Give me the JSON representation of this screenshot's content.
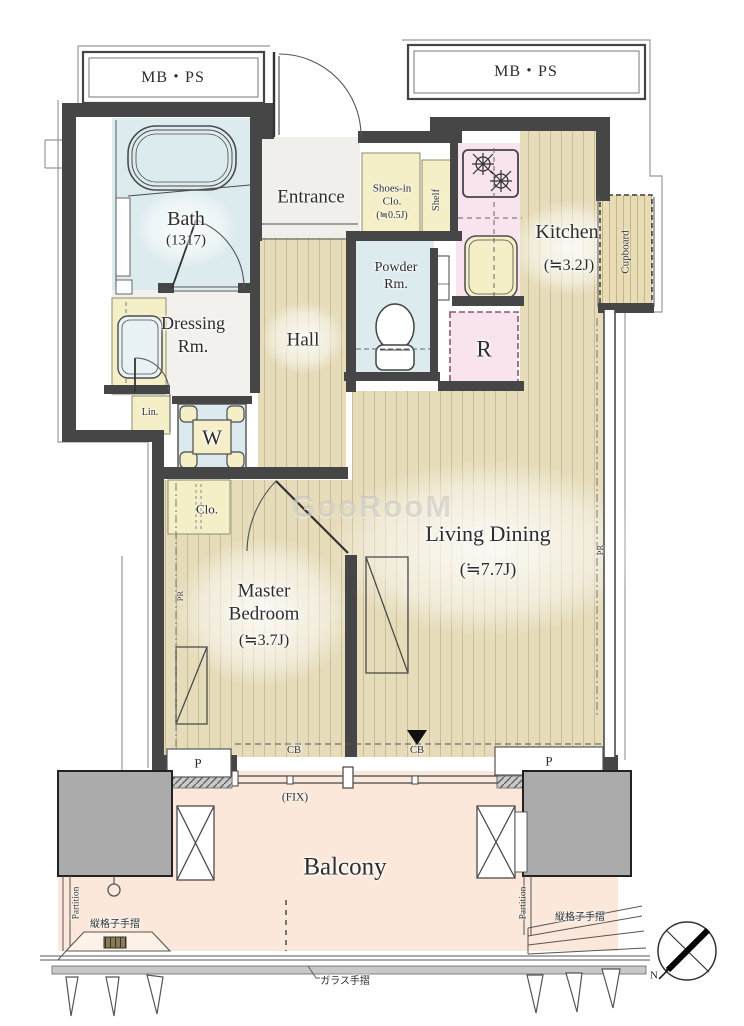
{
  "meta": {
    "type": "apartment-floor-plan",
    "watermark": "GooRooM"
  },
  "labels": {
    "mbps_left": "MB・PS",
    "mbps_right": "MB・PS",
    "bath": "Bath",
    "bath_size": "(1317)",
    "entrance": "Entrance",
    "shoes_line1": "Shoes-in",
    "shoes_line2": "Clo.",
    "shoes_line3": "(≒0.5J)",
    "shelf": "Shelf",
    "kitchen": "Kitchen",
    "kitchen_size": "(≒3.2J)",
    "cupboard": "Cupboard",
    "powder_line1": "Powder",
    "powder_line2": "Rm.",
    "fridge": "R",
    "dressing_line1": "Dressing",
    "dressing_line2": "Rm.",
    "linen": "Lin.",
    "washer": "W",
    "hall": "Hall",
    "closet": "Clo.",
    "master_line1": "Master",
    "master_line2": "Bedroom",
    "master_size": "(≒3.7J)",
    "living": "Living Dining",
    "living_size": "(≒7.7J)",
    "pr_left": "PR",
    "pr_right": "PR",
    "cb_left": "CB",
    "cb_right": "CB",
    "p_left": "P",
    "p_right": "P",
    "fix": "(FIX)",
    "balcony": "Balcony",
    "partition_left": "Partition",
    "partition_right": "Partition",
    "lattice_left": "縦格子手摺",
    "lattice_right": "縦格子手摺",
    "glass_rail": "ガラス手摺",
    "north": "N"
  },
  "colors": {
    "wall": "#464646",
    "wood_floor": "#e6dcba",
    "wood_stripe": "#b2a177",
    "wet_room_blue": "#dcebee",
    "storage_yellow": "#f5efc8",
    "kitchen_pink": "#f8e3ef",
    "balcony_peach": "#fbe8da",
    "pillar_gray": "#ababab",
    "entrance_gray": "#f0efeb"
  }
}
